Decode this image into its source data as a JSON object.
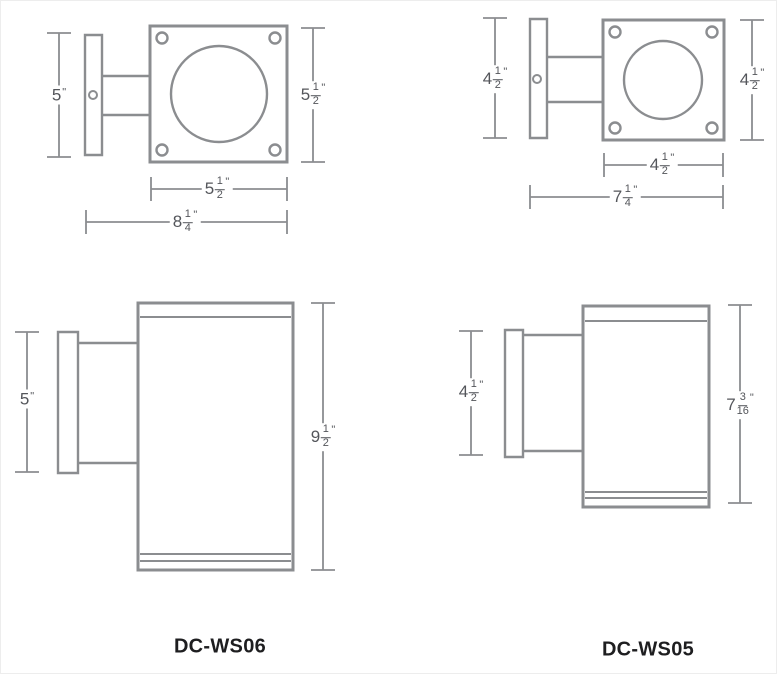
{
  "colors": {
    "bg": "#ffffff",
    "line": "#8b8d90",
    "text": "#54565b",
    "label-text": "#1e1e20"
  },
  "drawings": {
    "ws06_top": {
      "left": {
        "whole": "5",
        "unit": "\""
      },
      "right": {
        "whole": "5",
        "num": "1",
        "den": "2",
        "unit": "\""
      },
      "bottom_inner": {
        "whole": "5",
        "num": "1",
        "den": "2",
        "unit": "\""
      },
      "bottom_outer": {
        "whole": "8",
        "num": "1",
        "den": "4",
        "unit": "\""
      }
    },
    "ws05_top": {
      "left": {
        "whole": "4",
        "num": "1",
        "den": "2",
        "unit": "\""
      },
      "right": {
        "whole": "4",
        "num": "1",
        "den": "2",
        "unit": "\""
      },
      "bottom_inner": {
        "whole": "4",
        "num": "1",
        "den": "2",
        "unit": "\""
      },
      "bottom_outer": {
        "whole": "7",
        "num": "1",
        "den": "4",
        "unit": "\""
      }
    },
    "ws06_side": {
      "left": {
        "whole": "5",
        "unit": "\""
      },
      "right": {
        "whole": "9",
        "num": "1",
        "den": "2",
        "unit": "\""
      }
    },
    "ws05_side": {
      "left": {
        "whole": "4",
        "num": "1",
        "den": "2",
        "unit": "\""
      },
      "right": {
        "whole": "7",
        "num": "3",
        "den": "16",
        "unit": "\""
      }
    }
  },
  "labels": {
    "ws06": "DC-WS06",
    "ws05": "DC-WS05"
  }
}
